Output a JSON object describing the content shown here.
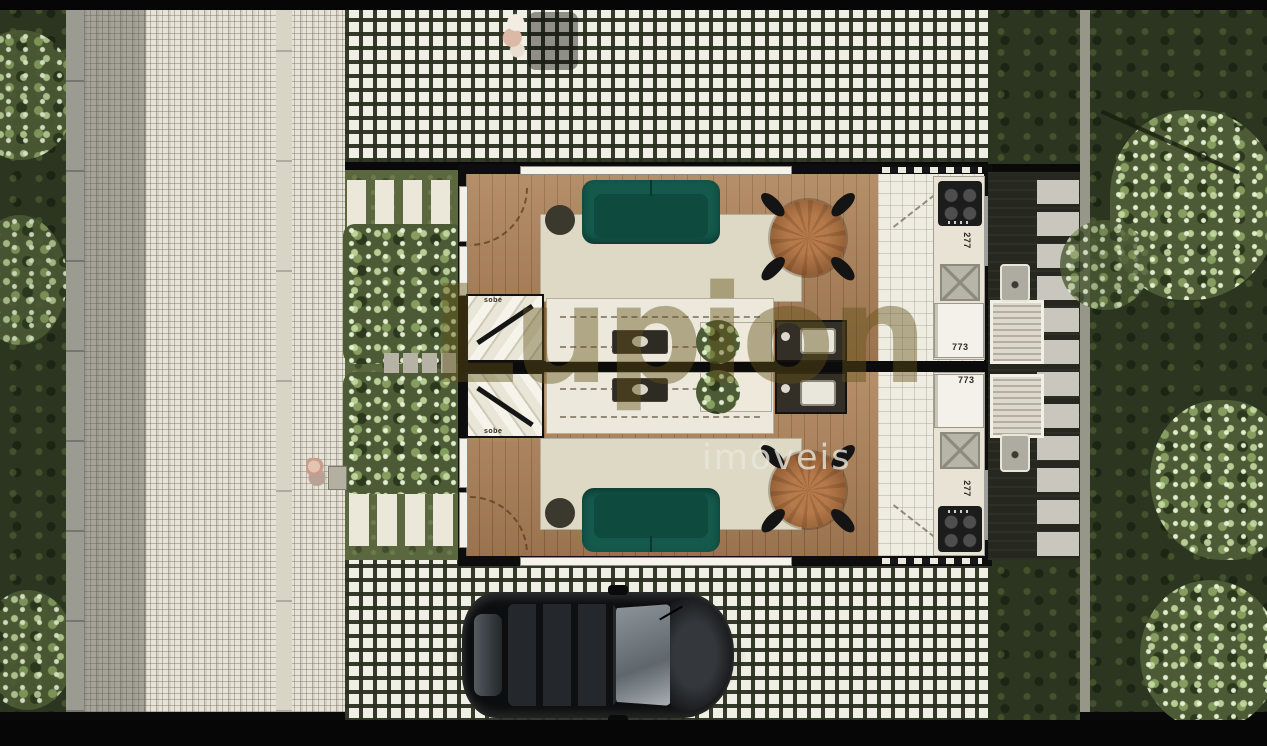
{
  "watermark": {
    "brand": "Lupion",
    "subtitle": "imóveis"
  },
  "plan": {
    "type": "duplex-site-plan-top-view",
    "units": [
      {
        "id": "upper",
        "stair_direction_label": "sobe",
        "stair_width_label": "80",
        "kitchen_counter_depth_label": "277",
        "kitchen_counter_length_label": "773"
      },
      {
        "id": "lower",
        "stair_direction_label": "sobe",
        "stair_width_label": "80",
        "kitchen_counter_depth_label": "277",
        "kitchen_counter_length_label": "773"
      }
    ]
  },
  "colors": {
    "sofa_teal": "#14594b",
    "wood_floor": "#a9805a",
    "rug_beige": "#ded9c5",
    "hedge_green": "#8fae6d",
    "deck_charcoal": "#26271f",
    "paver_white": "#f0efe6",
    "grass_dark": "#2b351f",
    "wall_black": "#0d0d0d"
  }
}
